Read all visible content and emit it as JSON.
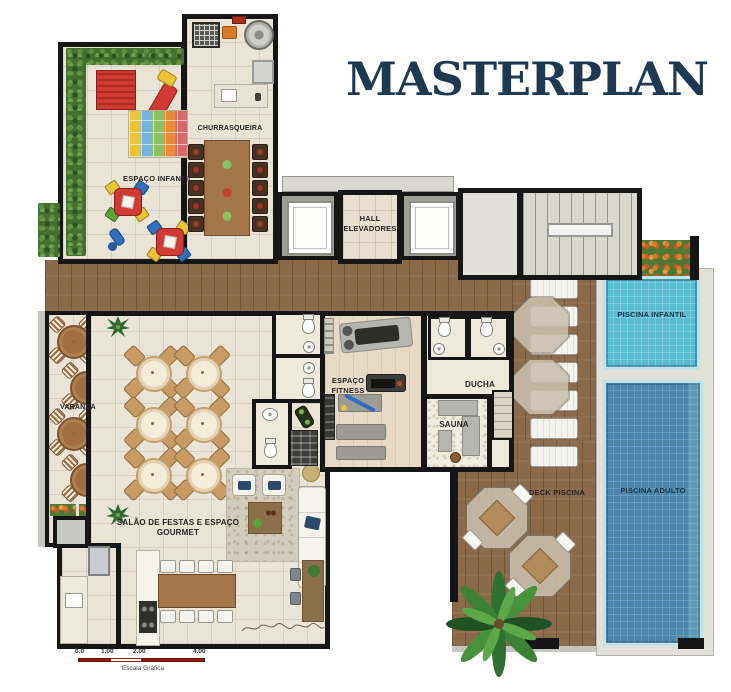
{
  "title": "MASTERPLAN",
  "rooms": {
    "espaco_infantil": "ESPAÇO INFANTIL",
    "churrasqueira": "CHURRASQUEIRA",
    "hall_elevadores": "HALL ELEVADORES",
    "varanda": "VARANDA",
    "espaco_fitness": "ESPAÇO FITNESS",
    "ducha": "DUCHA",
    "sauna": "SAUNA",
    "salao_festas": "SALÃO DE FESTAS E ESPAÇO GOURMET",
    "deck_piscina": "DECK PISCINA",
    "piscina_infantil": "PISCINA INFANTIL",
    "piscina_adulto": "PISCINA ADULTO"
  },
  "scale_bar": {
    "ticks": [
      "0.0",
      "1.00",
      "2.00",
      "4.00"
    ],
    "label": "Escala Gráfica"
  },
  "colors": {
    "accent_title": "#1d3a52",
    "wall": "#161616",
    "wood_deck": "#8a6a49",
    "pool_infantil": "#58bdd3",
    "pool_adulto": "#4c86ad",
    "hedge": "#41702f",
    "scale_red": "#8e1d12"
  }
}
